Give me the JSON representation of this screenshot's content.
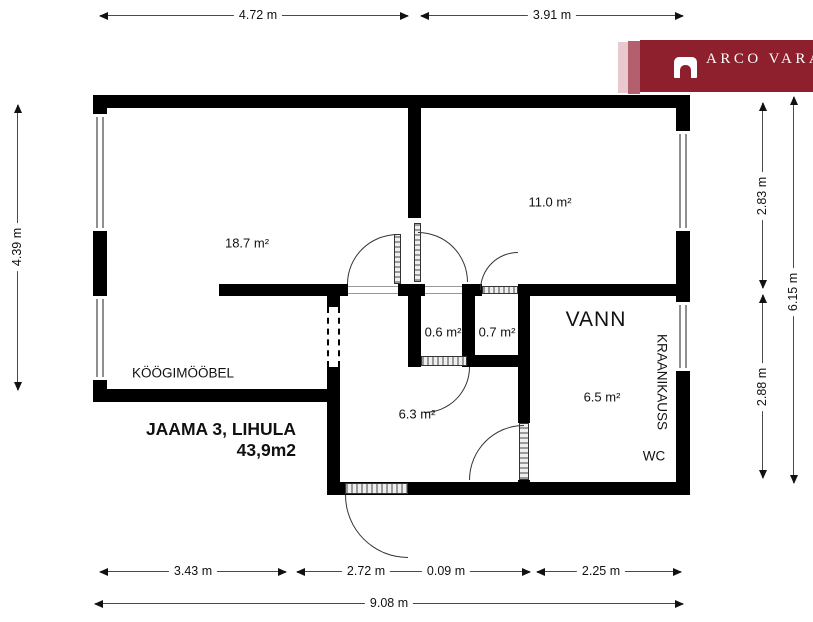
{
  "title": {
    "line1": "JAAMA 3, LIHULA",
    "line2": "43,9m2"
  },
  "logo": {
    "brand": "ARCO VARA",
    "bg_color": "#8e1f2c",
    "stripe_light": "#e7c9ce",
    "stripe_mid": "#b45f6d"
  },
  "rooms": {
    "living_area": "18.7 m²",
    "bedroom_area": "11.0 m²",
    "closet_left_area": "0.6 m²",
    "closet_right_area": "0.7 m²",
    "hall_area": "6.3 m²",
    "bathroom_area": "6.5 m²",
    "kitchen_label": "KÖÖGIMÖÖBEL",
    "bath_label": "VANN",
    "sink_label": "KRAANIKAUSS",
    "wc_label": "WC"
  },
  "dimensions": {
    "top_left": "4.72 m",
    "top_right": "3.91 m",
    "left_side": "4.39 m",
    "right_upper": "2.83 m",
    "right_lower": "2.88 m",
    "right_total": "6.15 m",
    "bottom_left": "3.43 m",
    "bottom_mid": "2.72 m",
    "bottom_small": "0.09 m",
    "bottom_right": "2.25 m",
    "bottom_total": "9.08 m"
  },
  "colors": {
    "wall": "#000000",
    "dim_line": "#4a4a4a",
    "window_line": "#8f8f8f"
  }
}
